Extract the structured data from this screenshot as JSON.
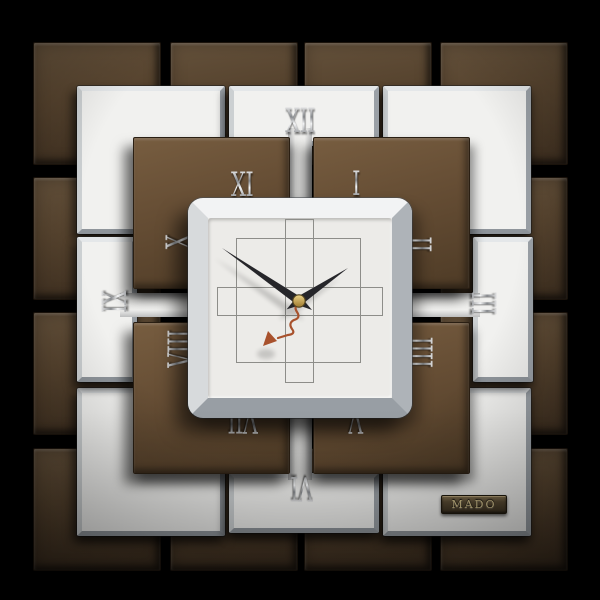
{
  "brand": {
    "label": "MADO"
  },
  "clock": {
    "style": "square tiled wall clock",
    "uses_iiii_for_four": true,
    "approximate_time_shown": "1:52:37",
    "hands": {
      "hour_angle_deg": 56,
      "minute_angle_deg": 304,
      "second_angle_deg": 219,
      "hour_color": "#26262a",
      "minute_color": "#26262a",
      "second_color": "#a8512c",
      "pin_color": "#c8a34c"
    },
    "numerals": [
      {
        "label": "XII",
        "x": 300,
        "y": 121,
        "rot": 0
      },
      {
        "label": "I",
        "x": 356,
        "y": 184,
        "rot": 0
      },
      {
        "label": "II",
        "x": 418,
        "y": 244,
        "rot": 90
      },
      {
        "label": "III",
        "x": 483,
        "y": 303,
        "rot": 90
      },
      {
        "label": "IIII",
        "x": 419,
        "y": 352,
        "rot": 90
      },
      {
        "label": "V",
        "x": 356,
        "y": 420,
        "rot": 180
      },
      {
        "label": "VI",
        "x": 302,
        "y": 488,
        "rot": 180
      },
      {
        "label": "VII",
        "x": 243,
        "y": 420,
        "rot": 180
      },
      {
        "label": "VIII",
        "x": 181,
        "y": 349,
        "rot": 270
      },
      {
        "label": "IX",
        "x": 115,
        "y": 302,
        "rot": 270
      },
      {
        "label": "X",
        "x": 179,
        "y": 242,
        "rot": 270
      },
      {
        "label": "XI",
        "x": 242,
        "y": 185,
        "rot": 0
      }
    ]
  },
  "tiles": {
    "outer_bronze": {
      "w": 126,
      "h": 121,
      "items": [
        [
          33,
          42
        ],
        [
          170,
          42
        ],
        [
          304,
          42
        ],
        [
          440,
          42
        ],
        [
          33,
          177
        ],
        [
          440,
          177
        ],
        [
          33,
          312
        ],
        [
          440,
          312
        ],
        [
          33,
          448
        ],
        [
          170,
          448
        ],
        [
          304,
          448
        ],
        [
          440,
          448
        ]
      ]
    },
    "silver_corner": {
      "w": 138,
      "h": 138,
      "items": [
        [
          77,
          86
        ],
        [
          383,
          86
        ],
        [
          77,
          388
        ],
        [
          383,
          388
        ]
      ]
    },
    "silver_mid": {
      "items": [
        [
          229,
          86,
          140,
          50
        ],
        [
          77,
          237,
          50,
          135
        ],
        [
          473,
          237,
          50,
          135
        ],
        [
          229,
          473,
          140,
          50
        ]
      ]
    },
    "strips": {
      "items": [
        [
          288,
          128,
          24,
          352,
          "v"
        ],
        [
          120,
          293,
          360,
          24,
          "h"
        ]
      ]
    },
    "inner_bronze": {
      "w": 155,
      "h": 150,
      "items": [
        [
          133,
          137
        ],
        [
          313,
          137
        ],
        [
          133,
          322
        ],
        [
          313,
          322
        ]
      ]
    }
  },
  "dial_pattern": {
    "square": {
      "x": 236,
      "y": 238,
      "w": 123,
      "h": 123
    },
    "vertical_bar": {
      "x": 285,
      "y": 219,
      "w": 27,
      "h": 162
    },
    "horizontal_bar": {
      "x": 217,
      "y": 287,
      "w": 164,
      "h": 27
    }
  },
  "colors": {
    "background": "#000000",
    "bronze_dark": "#57442f",
    "bronze_light": "#654d34",
    "silver_tile": "#f1f1ef",
    "dial": "#ecebe8",
    "pattern_line": "#8d8d89",
    "numeral_metal": "#d9dadc",
    "second_hand": "#a8512c",
    "pin_gold": "#c8a34c",
    "badge_text": "#d8c68f"
  }
}
